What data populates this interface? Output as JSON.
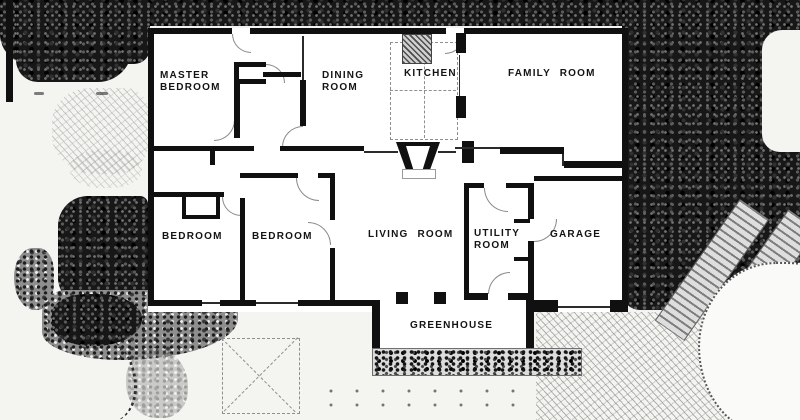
{
  "rooms": {
    "master_bedroom": {
      "line1": "MASTER",
      "line2": "BEDROOM"
    },
    "dining_room": {
      "line1": "DINING",
      "line2": "ROOM"
    },
    "kitchen": {
      "label": "KITCHEN"
    },
    "family_room": {
      "label": "FAMILY ROOM"
    },
    "bedroom_west": {
      "label": "BEDROOM"
    },
    "bedroom_center": {
      "label": "BEDROOM"
    },
    "living_room": {
      "label": "LIVING ROOM"
    },
    "utility_room": {
      "line1": "UTILITY",
      "line2": "ROOM"
    },
    "garage": {
      "label": "GARAGE"
    },
    "greenhouse": {
      "label": "GREENHOUSE"
    }
  },
  "colors": {
    "paper": "#f4f4f1",
    "wall": "#101010",
    "foliage": "#171717",
    "label_text": "#141414"
  }
}
